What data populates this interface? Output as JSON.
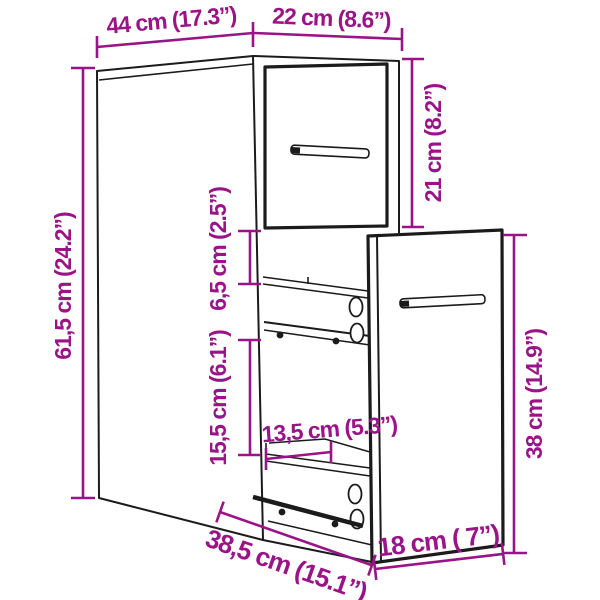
{
  "diagram": {
    "type": "product-dimension-diagram",
    "product": "narrow-pullout-storage-cabinet",
    "colors": {
      "dimension": "#9A1488",
      "line": "#1B1B1B",
      "background": "#FFFFFF"
    },
    "dimensions": {
      "top_depth": "44 cm (17.3”)",
      "top_width": "22 cm (8.6”)",
      "door_height": "21 cm (8.2”)",
      "total_height": "61,5 cm (24.2”)",
      "shelf_gap": "6,5 cm (2.5”)",
      "drawer_opening": "15,5 cm (6.1”)",
      "inner_drawer_width": "13,5 cm (5.3”)",
      "pullout_height": "38 cm (14.9”)",
      "extended_depth": "38,5 cm (15.1”)",
      "pullout_width": "18 cm ( 7”)"
    }
  }
}
